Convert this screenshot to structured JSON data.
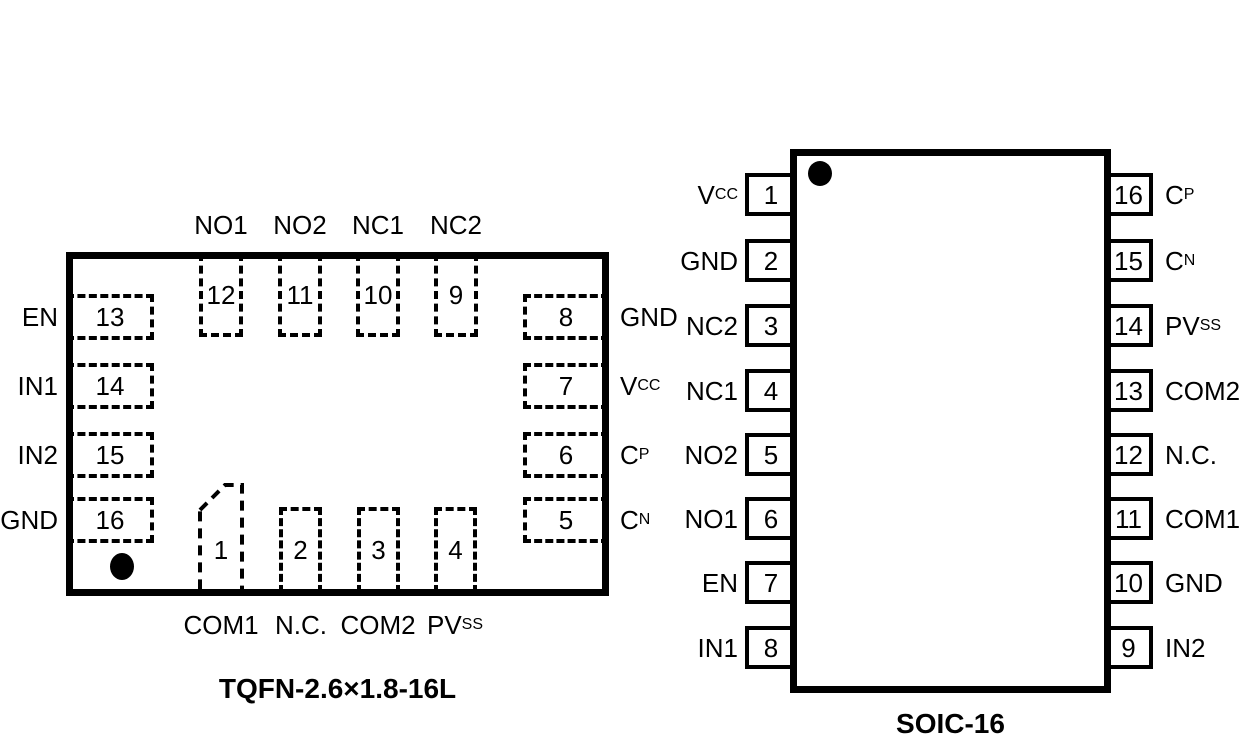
{
  "colors": {
    "ink": "#000000",
    "background": "#ffffff"
  },
  "tqfn": {
    "title": "TQFN-2.6×1.8-16L",
    "left_pins": [
      {
        "num": "13",
        "base": "EN",
        "sub": ""
      },
      {
        "num": "14",
        "base": "IN1",
        "sub": ""
      },
      {
        "num": "15",
        "base": "IN2",
        "sub": ""
      },
      {
        "num": "16",
        "base": "GND",
        "sub": ""
      }
    ],
    "top_pins": [
      {
        "num": "12",
        "base": "NO1",
        "sub": ""
      },
      {
        "num": "11",
        "base": "NO2",
        "sub": ""
      },
      {
        "num": "10",
        "base": "NC1",
        "sub": ""
      },
      {
        "num": "9",
        "base": "NC2",
        "sub": ""
      }
    ],
    "right_pins": [
      {
        "num": "8",
        "base": "GND",
        "sub": ""
      },
      {
        "num": "7",
        "base": "V",
        "sub": "CC"
      },
      {
        "num": "6",
        "base": "C",
        "sub": "P"
      },
      {
        "num": "5",
        "base": "C",
        "sub": "N"
      }
    ],
    "bottom_pins": [
      {
        "num": "1",
        "base": "COM1",
        "sub": ""
      },
      {
        "num": "2",
        "base": "N.C.",
        "sub": ""
      },
      {
        "num": "3",
        "base": "COM2",
        "sub": ""
      },
      {
        "num": "4",
        "base": "PV",
        "sub": "SS"
      }
    ]
  },
  "soic": {
    "title": "SOIC-16",
    "left_pins": [
      {
        "num": "1",
        "base": "V",
        "sub": "CC"
      },
      {
        "num": "2",
        "base": "GND",
        "sub": ""
      },
      {
        "num": "3",
        "base": "NC2",
        "sub": ""
      },
      {
        "num": "4",
        "base": "NC1",
        "sub": ""
      },
      {
        "num": "5",
        "base": "NO2",
        "sub": ""
      },
      {
        "num": "6",
        "base": "NO1",
        "sub": ""
      },
      {
        "num": "7",
        "base": "EN",
        "sub": ""
      },
      {
        "num": "8",
        "base": "IN1",
        "sub": ""
      }
    ],
    "right_pins": [
      {
        "num": "16",
        "base": "C",
        "sub": "P"
      },
      {
        "num": "15",
        "base": "C",
        "sub": "N"
      },
      {
        "num": "14",
        "base": "PV",
        "sub": "SS"
      },
      {
        "num": "13",
        "base": "COM2",
        "sub": ""
      },
      {
        "num": "12",
        "base": "N.C.",
        "sub": ""
      },
      {
        "num": "11",
        "base": "COM1",
        "sub": ""
      },
      {
        "num": "10",
        "base": "GND",
        "sub": ""
      },
      {
        "num": "9",
        "base": "IN2",
        "sub": ""
      }
    ]
  }
}
